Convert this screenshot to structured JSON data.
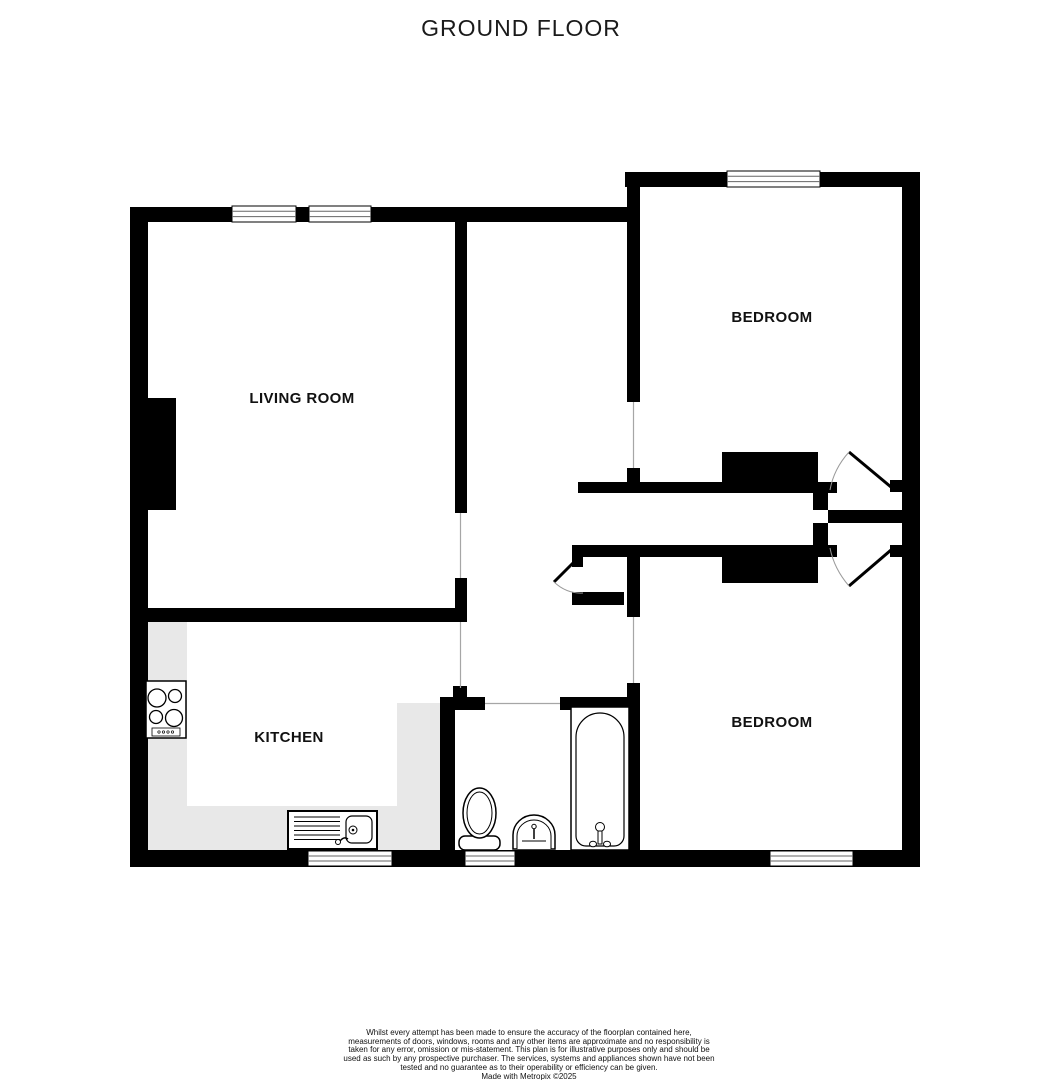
{
  "title": "GROUND FLOOR",
  "rooms": {
    "living_room": {
      "label": "LIVING ROOM"
    },
    "bedroom_top": {
      "label": "BEDROOM"
    },
    "kitchen": {
      "label": "KITCHEN"
    },
    "bedroom_bottom": {
      "label": "BEDROOM"
    }
  },
  "fixtures": [
    "hob",
    "kitchen-sink-drainer",
    "toilet",
    "basin",
    "bathtub",
    "built-in-wardrobe-top",
    "built-in-wardrobe-bottom",
    "chimney-breast"
  ],
  "footer": {
    "disclaimer": "Whilst every attempt has been made to ensure the accuracy of the floorplan contained here, measurements of doors, windows, rooms and any other items are approximate and no responsibility is taken for any error, omission or mis-statement. This plan is for illustrative purposes only and should be used as such by any prospective purchaser. The services, systems and appliances shown have not been tested and no guarantee as to their operability or efficiency can be given.",
    "credit": "Made with Metropix ©2025"
  },
  "colors": {
    "wall": "#000000",
    "counter": "#e8e8e8",
    "opening_line": "#a6a6a6",
    "background": "#ffffff"
  }
}
